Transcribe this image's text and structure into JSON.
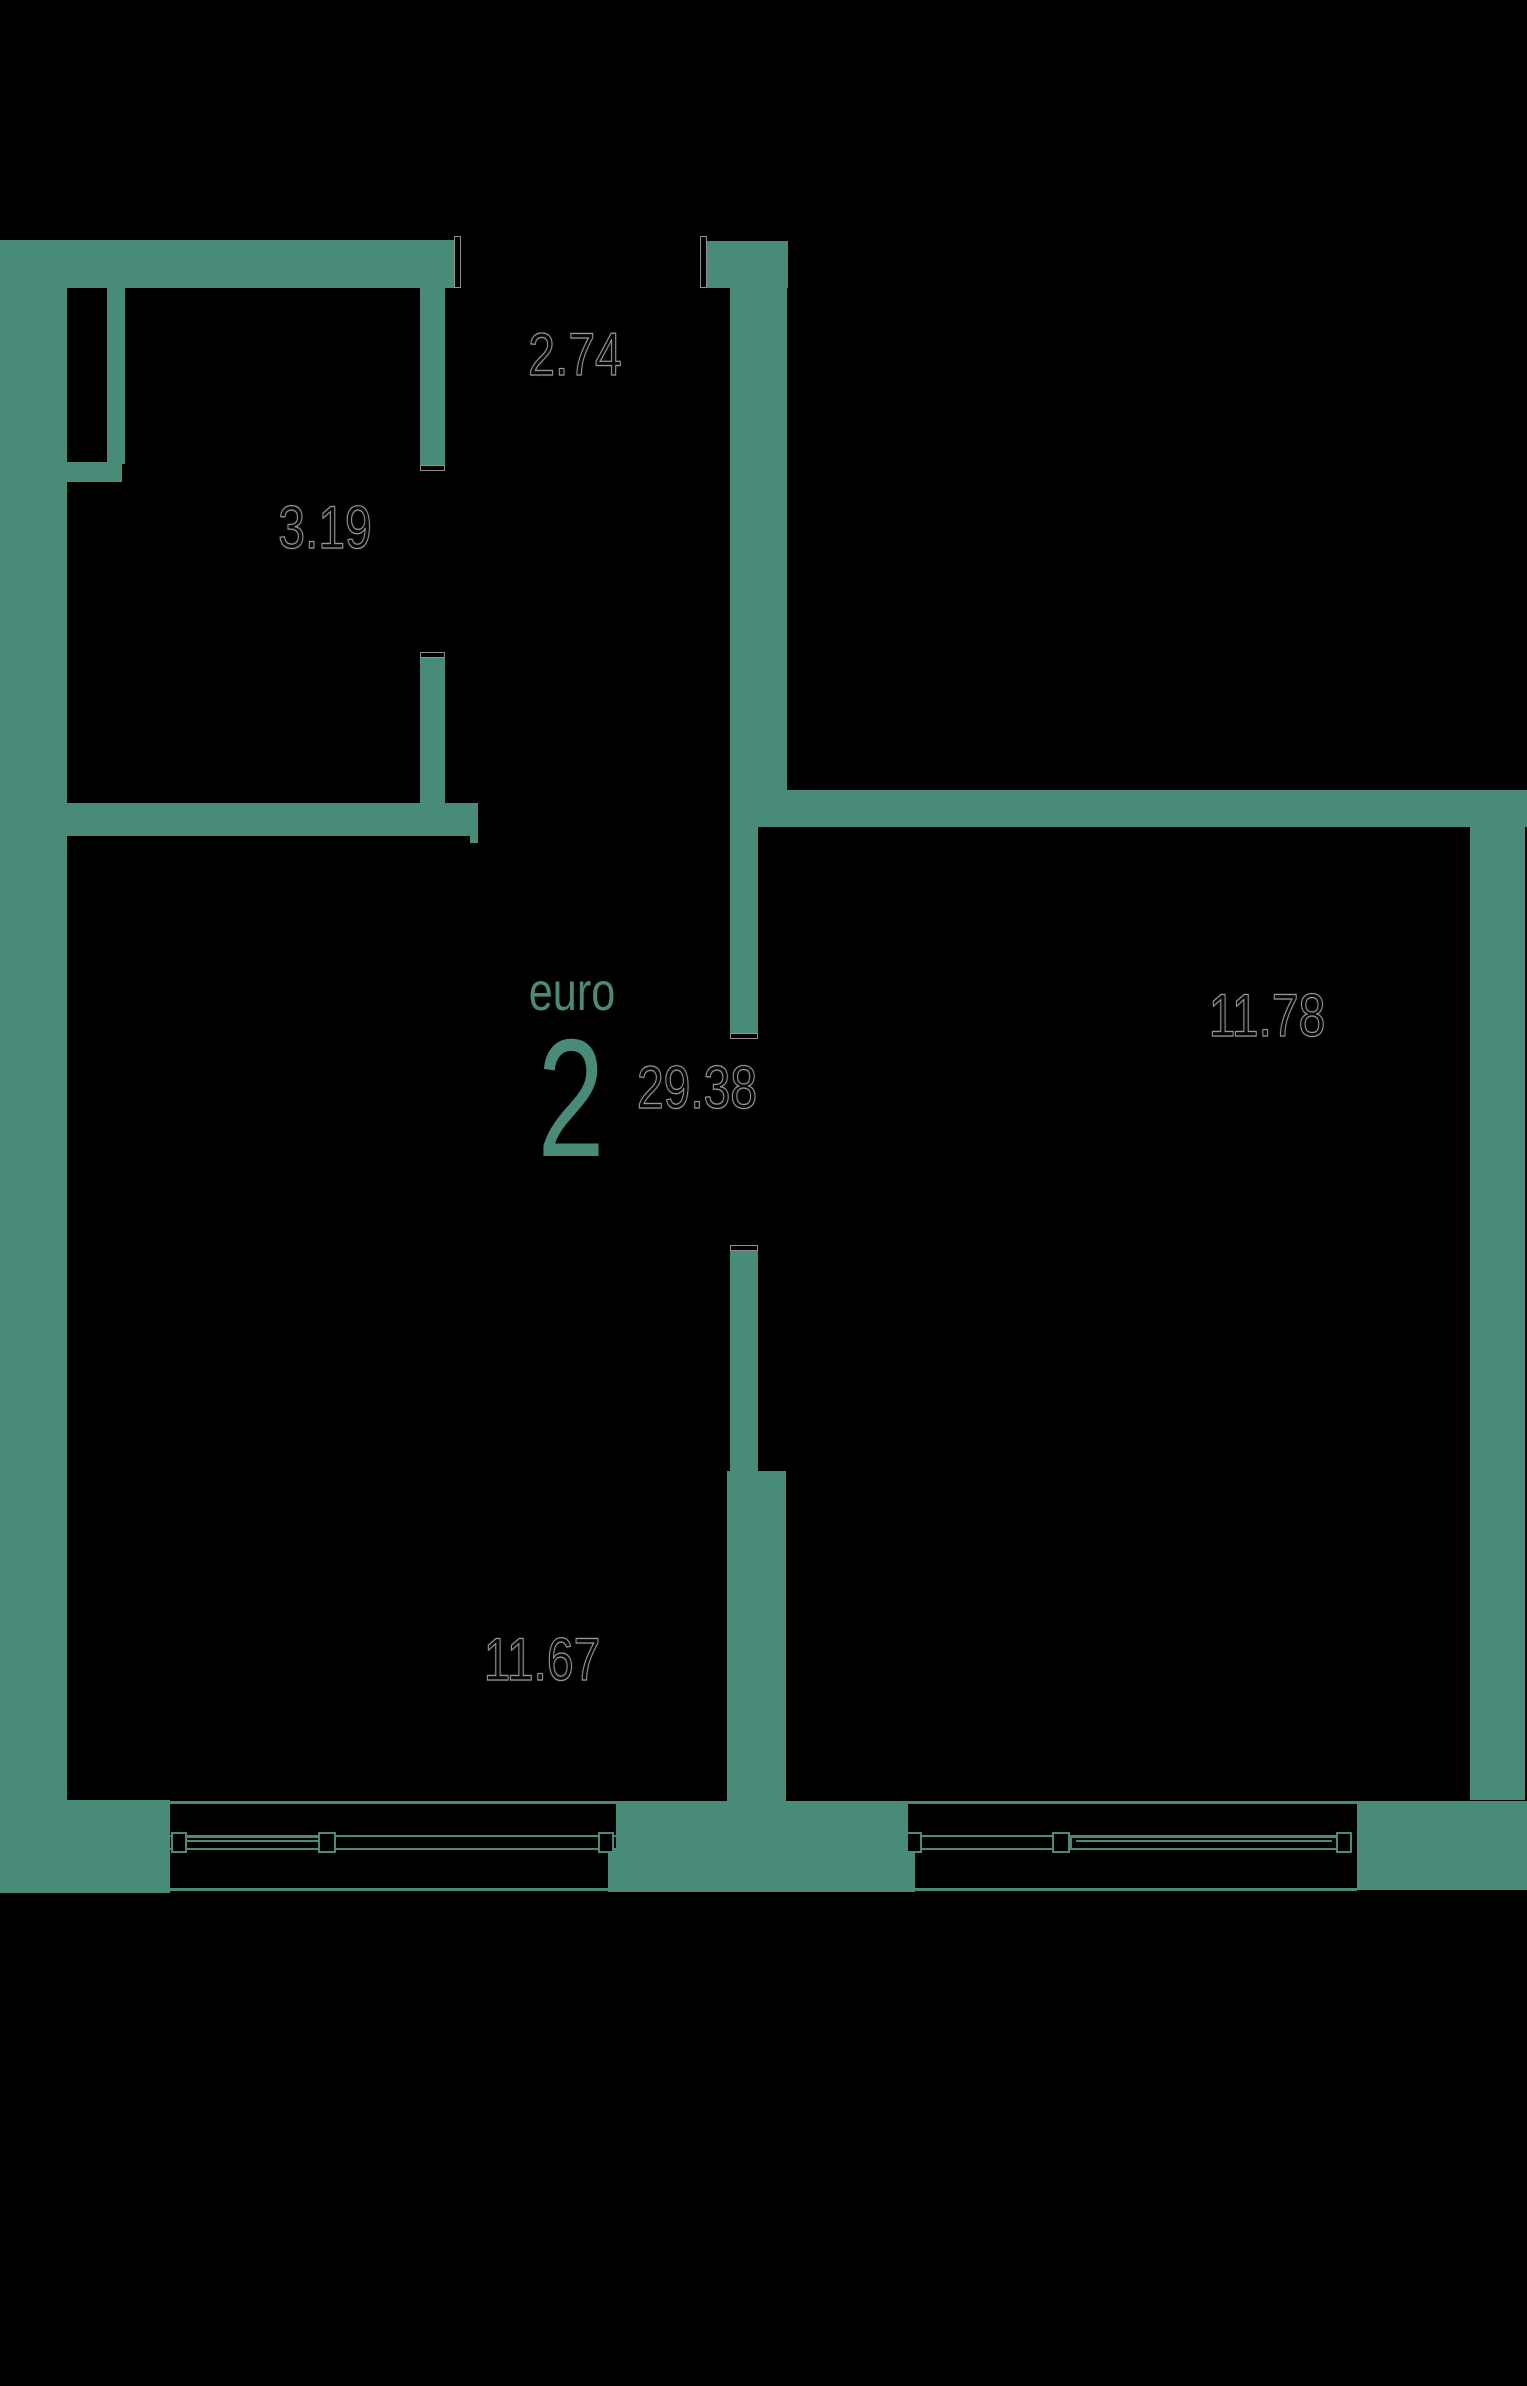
{
  "colors": {
    "accent": "#498b79",
    "background": "#000000"
  },
  "plan": {
    "type_label": "euro",
    "rooms_count": "2",
    "total_area": "29.38",
    "areas": {
      "hallway": "2.74",
      "storage": "3.19",
      "bedroom": "11.78",
      "living_kitchen": "11.67"
    }
  }
}
